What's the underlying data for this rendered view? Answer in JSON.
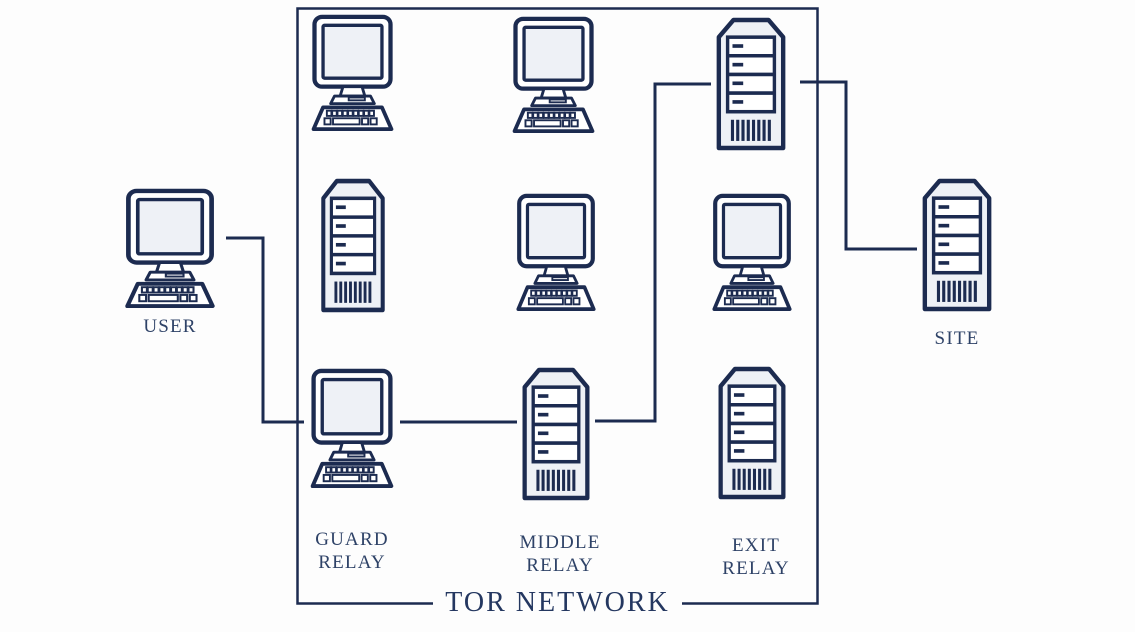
{
  "diagram": {
    "title": "TOR NETWORK",
    "user_label": "USER",
    "site_label": "SITE",
    "relays": [
      {
        "line1": "GUARD",
        "line2": "RELAY"
      },
      {
        "line1": "MIDDLE",
        "line2": "RELAY"
      },
      {
        "line1": "EXIT",
        "line2": "RELAY"
      }
    ],
    "path": [
      "USER",
      "GUARD RELAY",
      "MIDDLE RELAY",
      "EXIT RELAY",
      "SITE"
    ],
    "grid": {
      "rows": 3,
      "cols": 3,
      "cells": [
        [
          "desktop-computer",
          "desktop-computer",
          "server-tower"
        ],
        [
          "server-tower",
          "desktop-computer",
          "desktop-computer"
        ],
        [
          "desktop-computer",
          "server-tower",
          "server-tower"
        ]
      ]
    },
    "connections": [
      {
        "from": "user",
        "to": "guard-relay-computer"
      },
      {
        "from": "guard-relay-computer",
        "to": "middle-relay-server"
      },
      {
        "from": "middle-relay-server",
        "to": "exit-relay-server"
      },
      {
        "from": "exit-relay-server",
        "to": "site"
      }
    ],
    "icons": {
      "desktop": "desktop-computer-icon",
      "server": "server-tower-icon"
    },
    "colors": {
      "line": "#1c2b50",
      "icon_fill": "#eef1f6",
      "icon_white": "#ffffff",
      "label_text": "#2e4267",
      "title_text": "#243760",
      "background": "#fdfdfd"
    }
  }
}
